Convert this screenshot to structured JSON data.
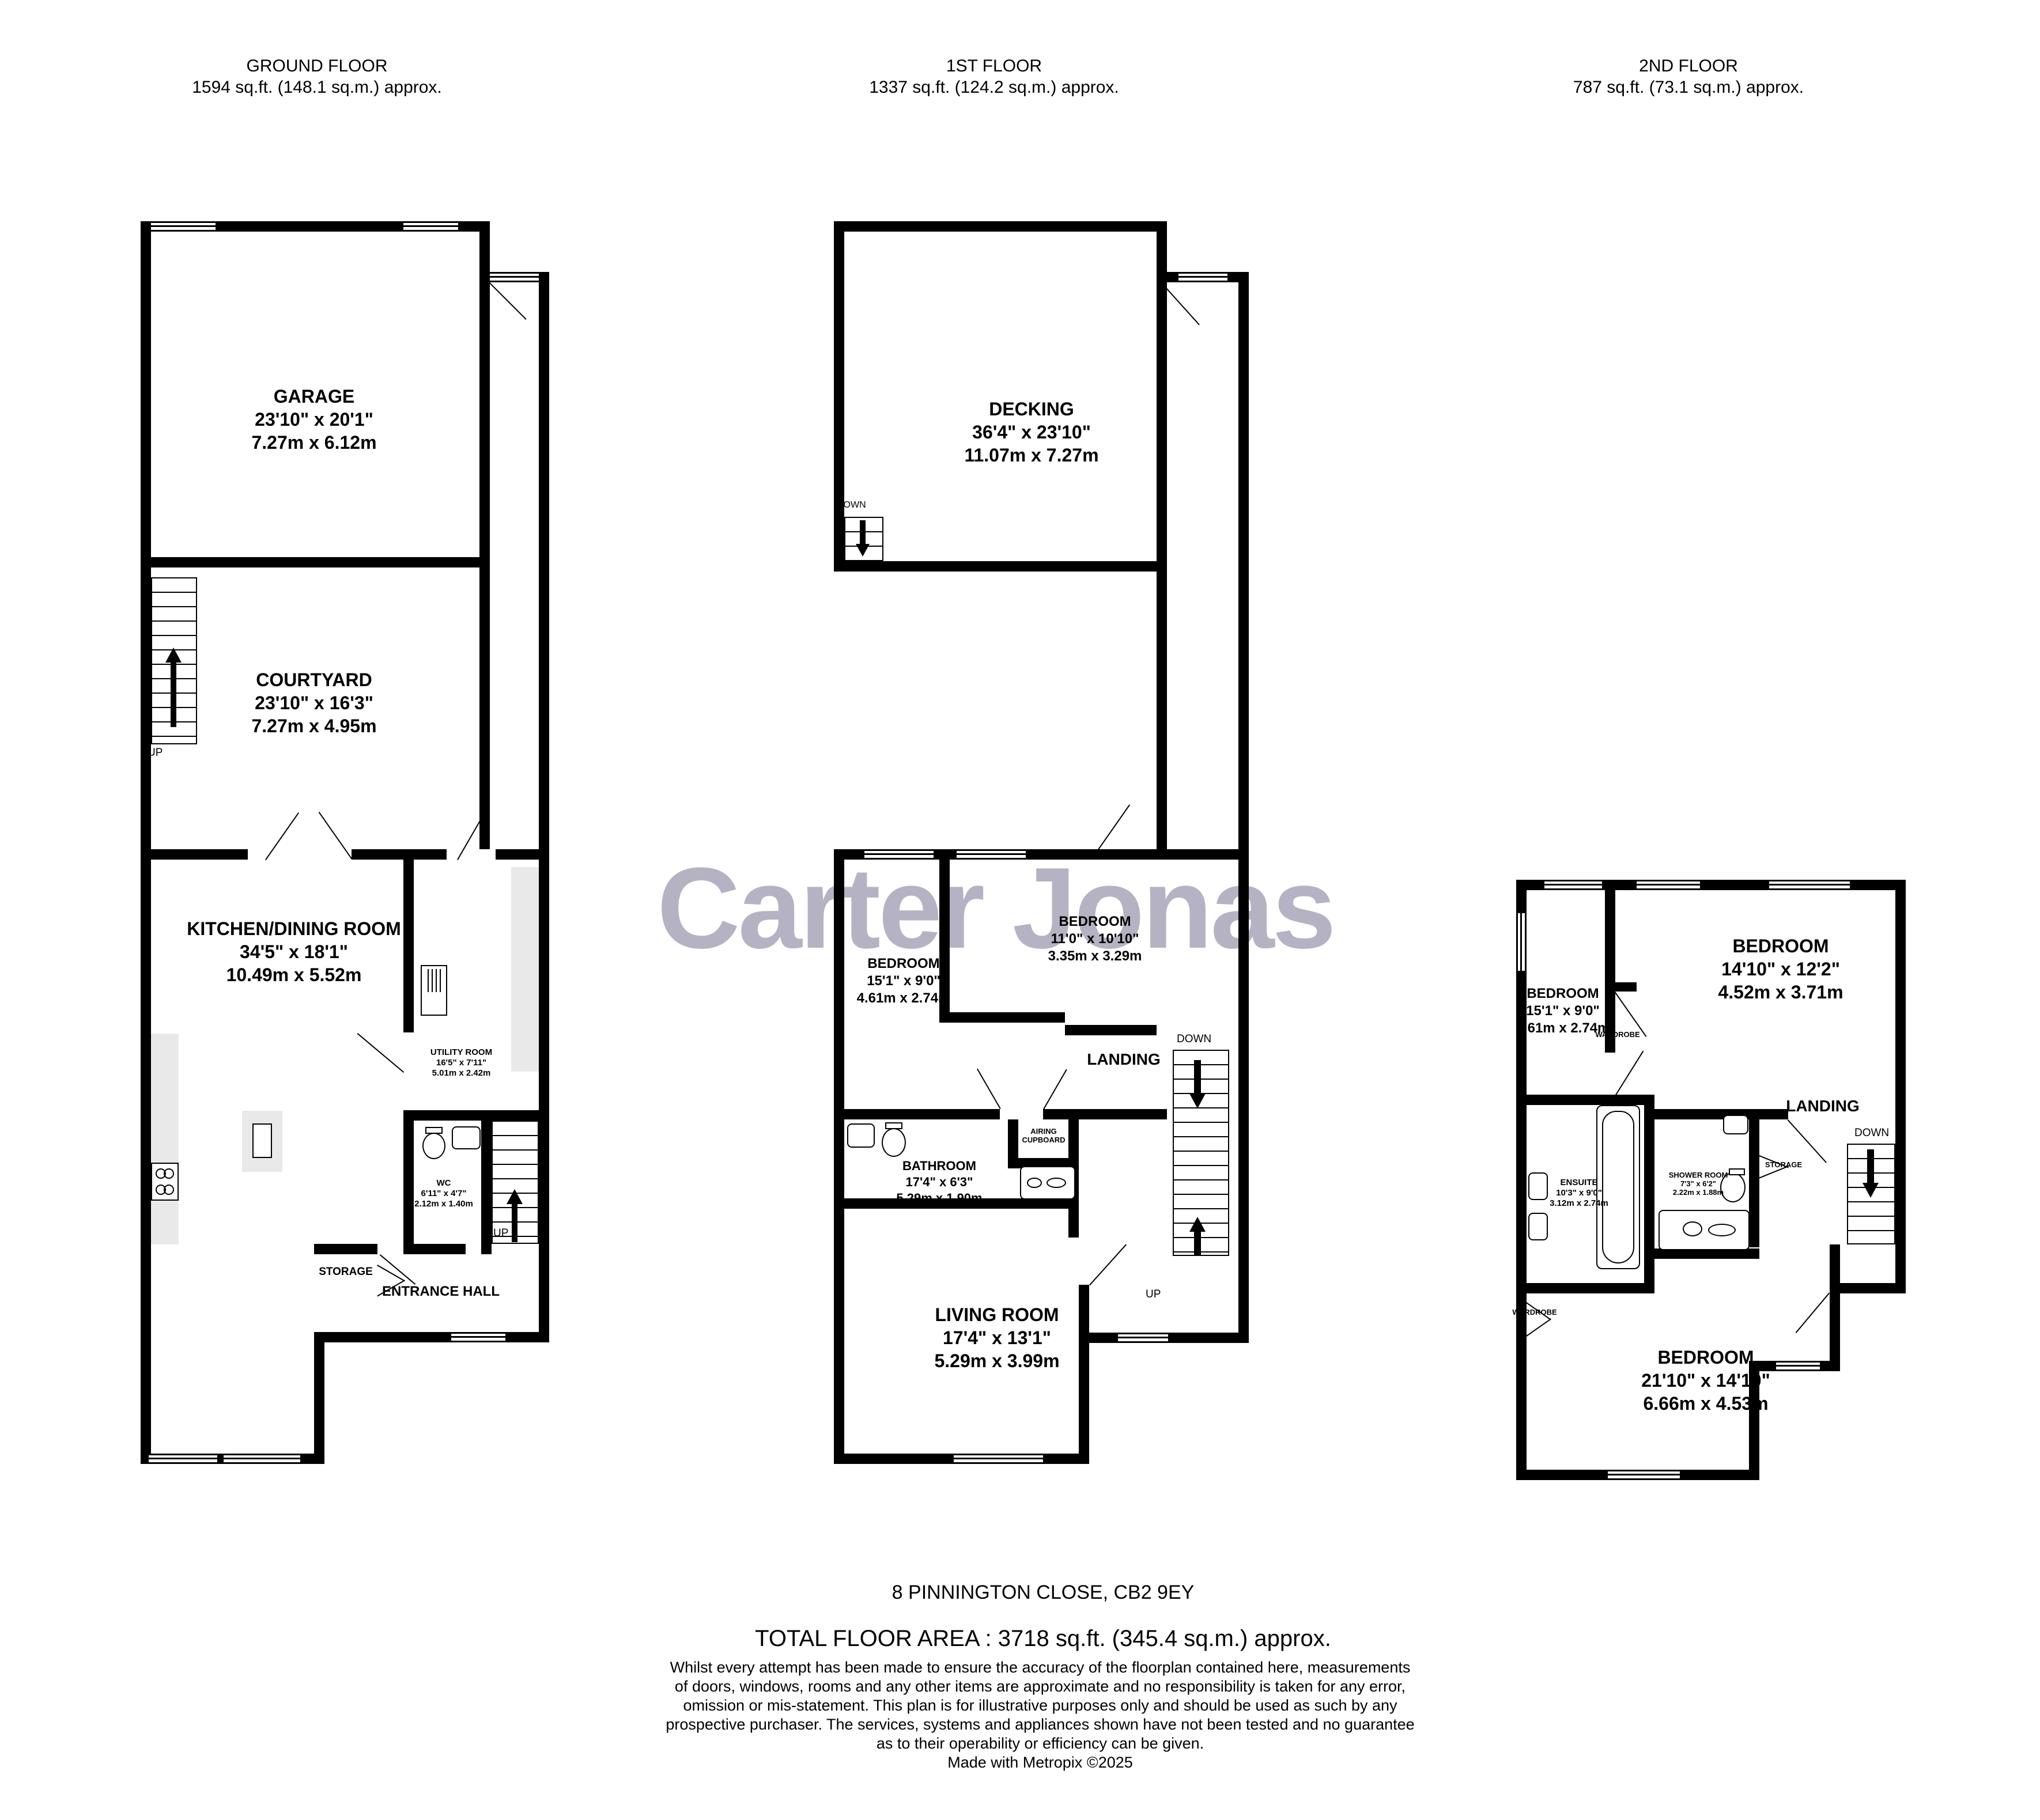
{
  "watermark": "Carter Jonas",
  "colors": {
    "wall": "#000000",
    "counter": "#e9e9e9",
    "watermark": "#b5b3c3"
  },
  "floors": {
    "ground": {
      "title": "GROUND FLOOR",
      "area": "1594 sq.ft. (148.1 sq.m.) approx.",
      "rooms": {
        "garage": {
          "name": "GARAGE",
          "imperial": "23'10\"  x 20'1\"",
          "metric": "7.27m  x 6.12m"
        },
        "courtyard": {
          "name": "COURTYARD",
          "imperial": "23'10\"  x 16'3\"",
          "metric": "7.27m  x 4.95m"
        },
        "kitchen": {
          "name": "KITCHEN/DINING ROOM",
          "imperial": "34'5\"  x 18'1\"",
          "metric": "10.49m  x 5.52m"
        },
        "utility": {
          "name": "UTILITY ROOM",
          "imperial": "16'5\"  x 7'11\"",
          "metric": "5.01m  x 2.42m"
        },
        "wc": {
          "name": "WC",
          "imperial": "6'11\"  x 4'7\"",
          "metric": "2.12m  x 1.40m"
        },
        "entrance": {
          "name": "ENTRANCE HALL"
        },
        "storage": {
          "name": "STORAGE"
        }
      },
      "labels": {
        "up_courtyard": "UP",
        "up_hall": "UP"
      }
    },
    "first": {
      "title": "1ST FLOOR",
      "area": "1337 sq.ft. (124.2 sq.m.) approx.",
      "rooms": {
        "decking": {
          "name": "DECKING",
          "imperial": "36'4\"  x 23'10\"",
          "metric": "11.07m  x 7.27m"
        },
        "bedroom1": {
          "name": "BEDROOM",
          "imperial": "15'1\"  x 9'0\"",
          "metric": "4.61m  x 2.74m"
        },
        "bedroom2": {
          "name": "BEDROOM",
          "imperial": "11'0\"  x 10'10\"",
          "metric": "3.35m  x 3.29m"
        },
        "bathroom": {
          "name": "BATHROOM",
          "imperial": "17'4\"  x 6'3\"",
          "metric": "5.29m  x 1.90m"
        },
        "living": {
          "name": "LIVING ROOM",
          "imperial": "17'4\"  x 13'1\"",
          "metric": "5.29m  x 3.99m"
        },
        "landing": {
          "name": "LANDING"
        },
        "airing": {
          "name": "AIRING CUPBOARD"
        }
      },
      "labels": {
        "down_decking": "DOWN",
        "down_stairs": "DOWN",
        "up_stairs": "UP"
      }
    },
    "second": {
      "title": "2ND FLOOR",
      "area": "787 sq.ft. (73.1 sq.m.) approx.",
      "rooms": {
        "bedroom1": {
          "name": "BEDROOM",
          "imperial": "15'1\"  x 9'0\"",
          "metric": "4.61m  x 2.74m"
        },
        "bedroom2": {
          "name": "BEDROOM",
          "imperial": "14'10\"  x 12'2\"",
          "metric": "4.52m  x 3.71m"
        },
        "bedroom3": {
          "name": "BEDROOM",
          "imperial": "21'10\"  x 14'10\"",
          "metric": "6.66m  x 4.53m"
        },
        "ensuite": {
          "name": "ENSUITE",
          "imperial": "10'3\"  x 9'0\"",
          "metric": "3.12m  x 2.74m"
        },
        "shower": {
          "name": "SHOWER ROOM",
          "imperial": "7'3\"  x 6'2\"",
          "metric": "2.22m  x 1.88m"
        },
        "landing": {
          "name": "LANDING"
        },
        "storage": {
          "name": "STORAGE"
        },
        "wardrobe_top": {
          "name": "WARDROBE"
        },
        "wardrobe_bottom": {
          "name": "WARDROBE"
        }
      },
      "labels": {
        "down_stairs": "DOWN"
      }
    }
  },
  "footer": {
    "address": "8 PINNINGTON CLOSE, CB2 9EY",
    "total_area": "TOTAL FLOOR AREA : 3718 sq.ft. (345.4 sq.m.) approx.",
    "disclaimer": "Whilst every attempt has been made to ensure the accuracy of the floorplan contained here, measurements of doors, windows, rooms and any other items are approximate and no responsibility is taken for any error, omission or mis-statement. This plan is for illustrative purposes only and should be used as such by any prospective purchaser. The services, systems and appliances shown have not been tested and no guarantee as to their operability or efficiency can be given.",
    "credit": "Made with Metropix ©2025"
  }
}
